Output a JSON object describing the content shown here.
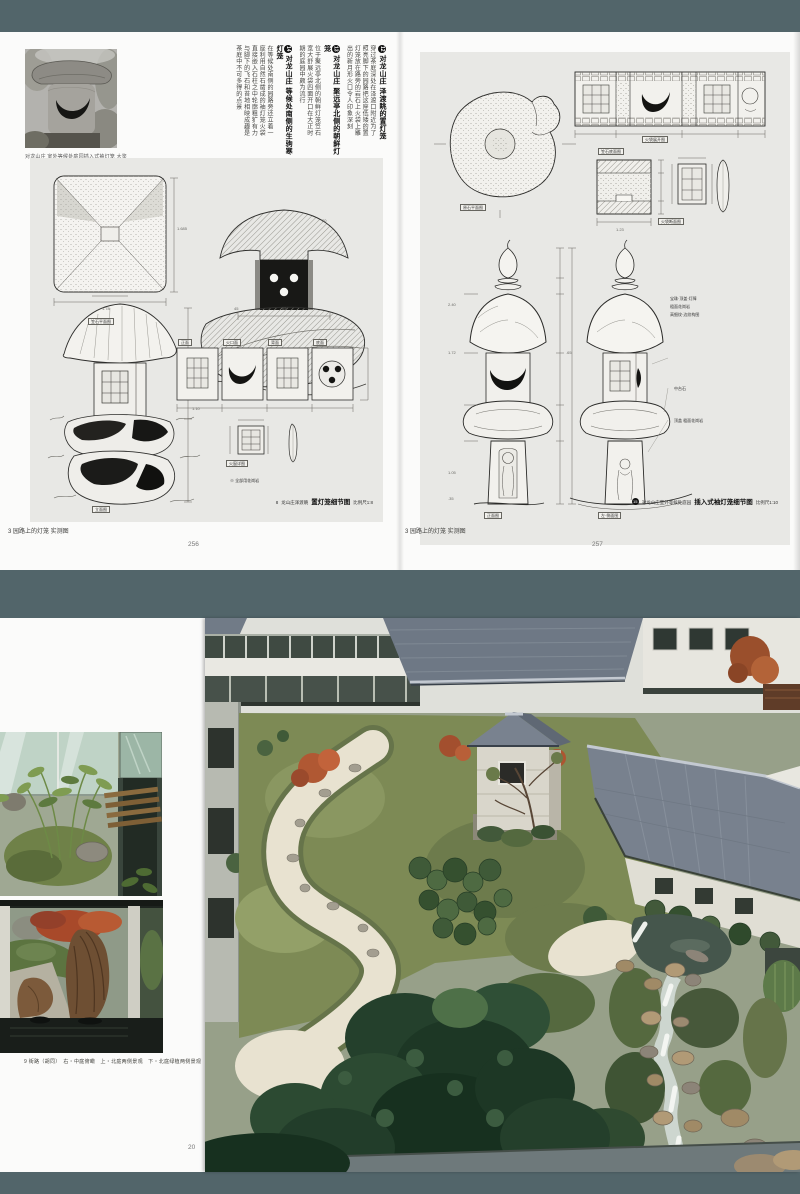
{
  "colors": {
    "background_teal": "#52656a",
    "page_white": "#fbfbfa",
    "panel_gray": "#e8e8e5",
    "ink": "#2b2b29"
  },
  "top_spread": {
    "left_page": {
      "photo_caption": "对龙山庄 室外等候处庭园插入式袖灯笼 大鉴",
      "columns": [
        {
          "type": "heading",
          "num": "12",
          "text": "对龙山庄 泽渡眺的置灯笼"
        },
        {
          "type": "body",
          "num": "",
          "text": "穿过茶庭深处在泽渡口附近为了"
        },
        {
          "type": "body",
          "num": "",
          "text": "照亮脚下的园路把这座低矮的置"
        },
        {
          "type": "body",
          "num": "",
          "text": "灯笼放在路旁的岩石上火袋上雕"
        },
        {
          "type": "body",
          "num": "",
          "text": "出的新月形火口令人印象深刻"
        },
        {
          "type": "heading",
          "num": "13",
          "text": "对龙山庄 聚远亭北侧的朝鲜灯笼"
        },
        {
          "type": "body",
          "num": "",
          "text": "位于聚远亭北侧的朝鲜灯笼笠石"
        },
        {
          "type": "body",
          "num": "",
          "text": "宽大舒展火袋四面开口在大正时"
        },
        {
          "type": "body",
          "num": "",
          "text": "期的庭园中颇为流行"
        },
        {
          "type": "heading",
          "num": "14",
          "text": "对龙山庄 等候处南侧的生驹寒灯笼"
        },
        {
          "type": "body",
          "num": "",
          "text": "在等候处南侧的园路旁还立着一"
        },
        {
          "type": "body",
          "num": "",
          "text": "座利用自然石凿成的袖灯笼火袋"
        },
        {
          "type": "body",
          "num": "",
          "text": "直接嵌入石柱之中轮廓粗犷有力"
        },
        {
          "type": "body",
          "num": "",
          "text": "与脚下的飞石和苔地相映成趣是"
        },
        {
          "type": "body",
          "num": "",
          "text": "茶庭中不可多得的点景"
        }
      ],
      "panel": {
        "labels": {
          "plan": "笠石平面图",
          "strip": [
            "正面",
            "火口面",
            "背面",
            "底面"
          ],
          "elevation": "立面图",
          "window_detail": "火窗详图",
          "note": "※ 全部用花岗岩"
        },
        "dims": [
          "1.685",
          "1.78",
          "1.10",
          "45",
          "65",
          "30"
        ],
        "caption_num": "8",
        "caption_prefix": "龙山庄泽渡眺",
        "caption_bold": "置灯笼细节图",
        "caption_scale": "比例尺1:8"
      },
      "footer": "3 园路上的灯笼 实测图",
      "page_number": "256"
    },
    "right_page": {
      "panel": {
        "labels": {
          "plan": "原石平面图",
          "strip1": "火袋展开图",
          "strip2": "笠石底面图",
          "section": "火袋断面图",
          "front": "正面图",
          "side": "左·侧面图"
        },
        "annotations": [
          "宝珠·顶盖·灯障",
          "粗面花岗岩",
          "高细纹·边纹构图",
          "中台石",
          "顶盖 粗面花岗岩"
        ],
        "dims": [
          "1.23",
          "2.40",
          "1.72",
          "1.05",
          ".65",
          ".35"
        ],
        "caption_num": "15",
        "caption_prefix": "对龙山庄室外等候处庭园",
        "caption_bold": "插入式袖灯笼细节图",
        "caption_scale": "比例尺1:10"
      },
      "footer": "3 园路上的灯笼 实测图",
      "page_number": "257"
    }
  },
  "bottom_spread": {
    "caption": "9 街路（胡同）　右・中庭俯瞰　上・北庭两侧景观　下・北庭绿植两侧景观",
    "page_number": "20"
  }
}
